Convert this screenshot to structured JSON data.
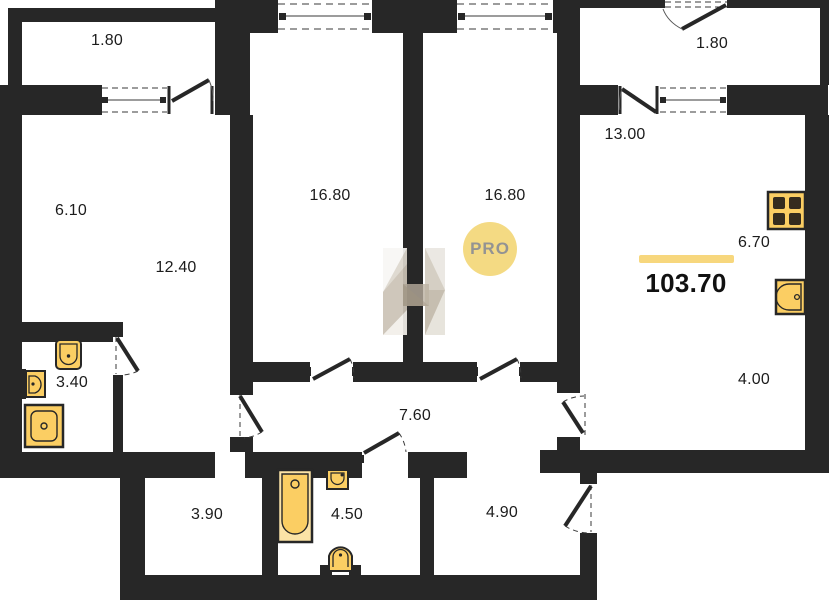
{
  "plan": {
    "title": "apartment-floor-plan",
    "total": {
      "area": "103.70"
    },
    "watermark": {
      "badge": "PRO"
    },
    "colors": {
      "wall": "#272727",
      "fixture_fill": "#fbce63",
      "fixture_light": "#fce3a6",
      "accent_bar": "#f7d77d",
      "badge_bg": "#f4d97e",
      "badge_text": "#8f8f8f",
      "label_text": "#1c1c1c"
    },
    "rooms": [
      {
        "id": "balcony-left",
        "area": "1.80"
      },
      {
        "id": "balcony-right",
        "area": "1.80"
      },
      {
        "id": "room-left-upper",
        "area": "6.10"
      },
      {
        "id": "room-left-lower",
        "area": "12.40"
      },
      {
        "id": "bedroom-1",
        "area": "16.80"
      },
      {
        "id": "bedroom-2",
        "area": "16.80"
      },
      {
        "id": "kitchen-living",
        "area": "13.00"
      },
      {
        "id": "kitchen-zone",
        "area": "6.70"
      },
      {
        "id": "bathroom-left",
        "area": "3.40"
      },
      {
        "id": "hallway",
        "area": "7.60"
      },
      {
        "id": "hall-right",
        "area": "4.00"
      },
      {
        "id": "storage",
        "area": "3.90"
      },
      {
        "id": "bathroom-bottom",
        "area": "4.50"
      },
      {
        "id": "entry-hall",
        "area": "4.90"
      }
    ]
  }
}
